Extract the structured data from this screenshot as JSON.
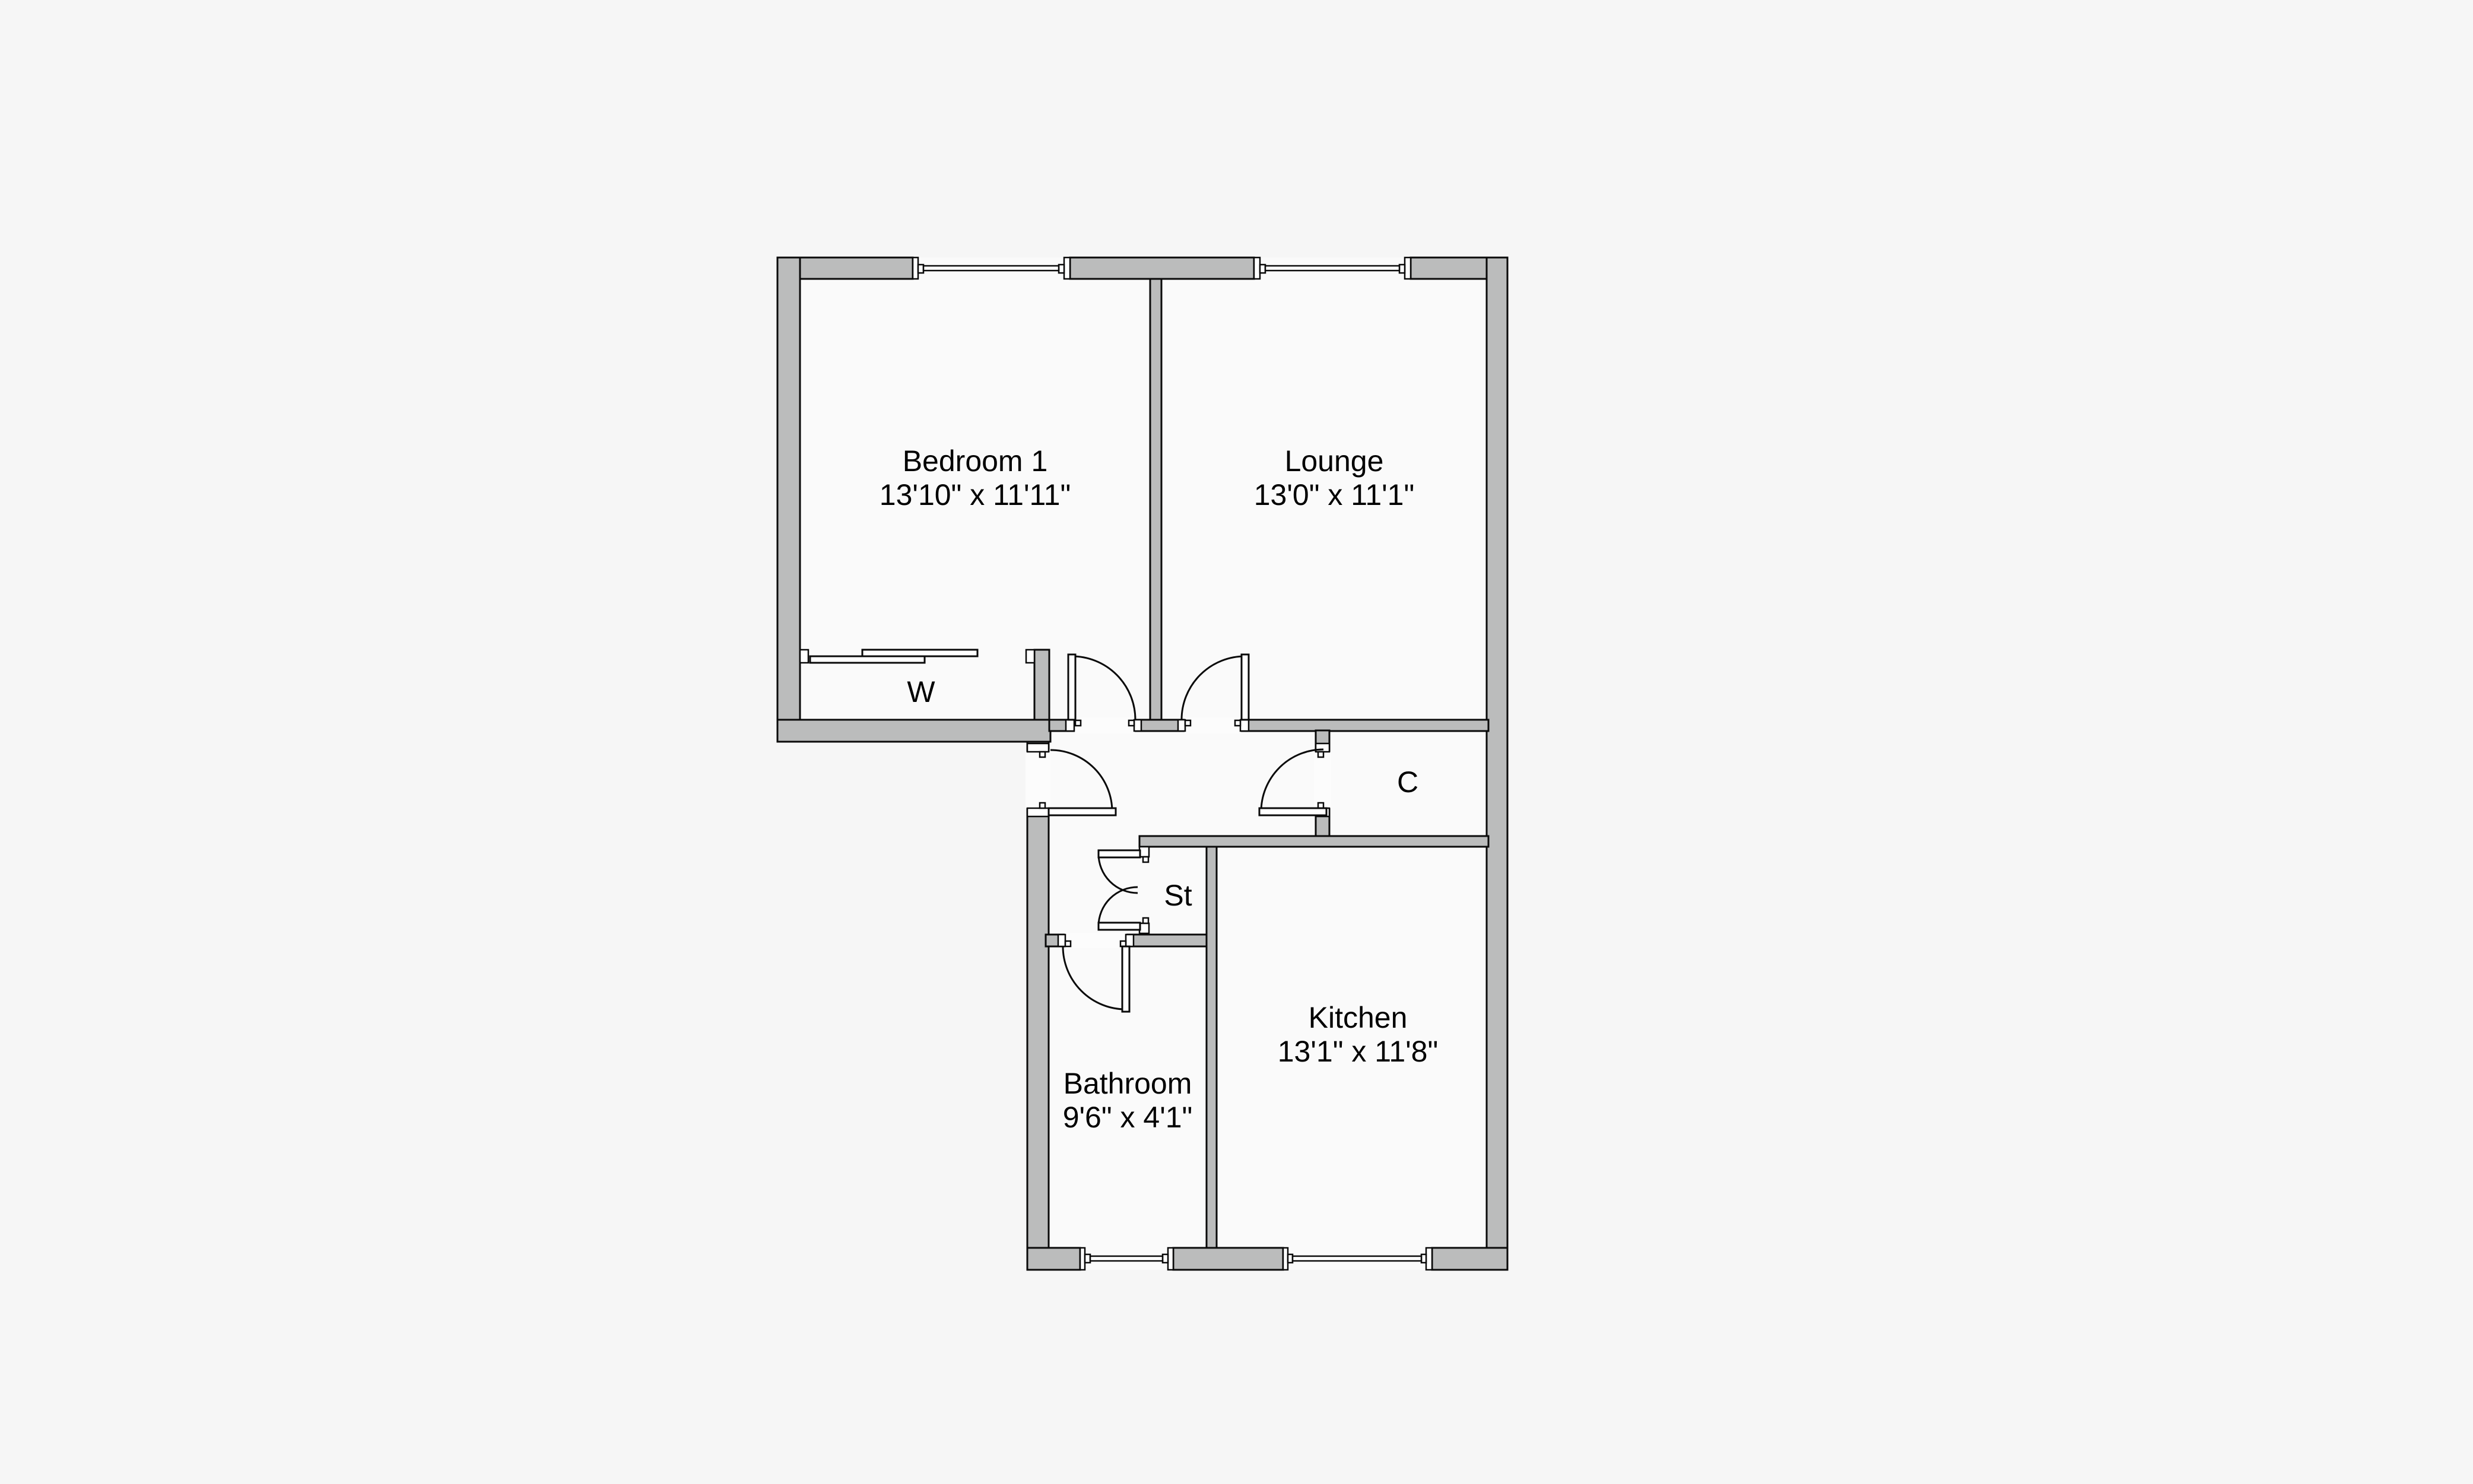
{
  "palette": {
    "background": "#f6f6f6",
    "room-fill": "#fafafa",
    "wall-fill": "#bbbcbc",
    "line": "#0a0a0a",
    "text": "#000000"
  },
  "floorplan": {
    "rooms": [
      {
        "id": "bedroom-1",
        "name": "Bedroom 1",
        "dimensions": "13'10\" x 11'11\""
      },
      {
        "id": "lounge",
        "name": "Lounge",
        "dimensions": "13'0\" x 11'1\""
      },
      {
        "id": "kitchen",
        "name": "Kitchen",
        "dimensions": "13'1\" x 11'8\""
      },
      {
        "id": "bathroom",
        "name": "Bathroom",
        "dimensions": "9'6\" x 4'1\""
      }
    ],
    "closets": [
      {
        "id": "wardrobe",
        "label": "W"
      },
      {
        "id": "cupboard",
        "label": "C"
      },
      {
        "id": "storage",
        "label": "St"
      }
    ]
  }
}
